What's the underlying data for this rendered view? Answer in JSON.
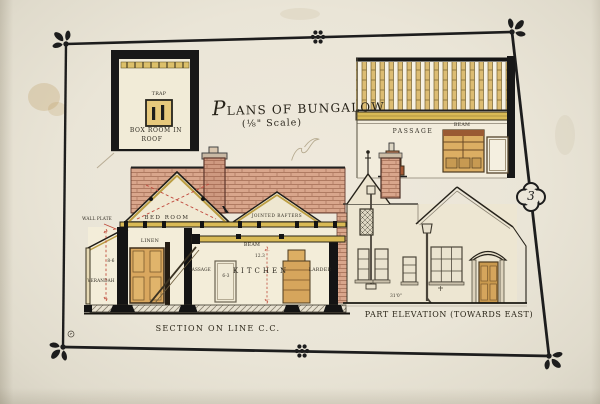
{
  "title": {
    "main": "PLANS OF BUNGALOW",
    "scale": "(⅛\" Scale)"
  },
  "page_badge": "3",
  "box_room_plan": {
    "trap": "TRAP",
    "caption_line1": "BOX ROOM IN",
    "caption_line2": "ROOF"
  },
  "passage_section": {
    "passage": "PASSAGE",
    "beam": "BEAM"
  },
  "section": {
    "caption": "SECTION ON LINE C.C.",
    "wall_plate": "WALL PLATE",
    "bed_room": "BED ROOM",
    "rafters": "JOINTED RAFTERS",
    "beam": "BEAM",
    "linen": "LINEN",
    "stair_passage": "PASSAGE",
    "verandah": "VERANDAH",
    "kitchen": "KITCHEN",
    "larder": "LARDER",
    "dim_verandah": "8-6",
    "dim_door": "6-3",
    "dim_kitchen": "12.3"
  },
  "elevation": {
    "caption": "PART ELEVATION (TOWARDS EAST)",
    "dim_width": "31'0\""
  },
  "colors": {
    "ink": "#1d1d1d",
    "paper": "#eae5d7",
    "brick": "#d9a68c",
    "beam_yellow": "#d9ba55",
    "wood_tan": "#d9a75e",
    "section_line_red": "#bf4a3a"
  }
}
